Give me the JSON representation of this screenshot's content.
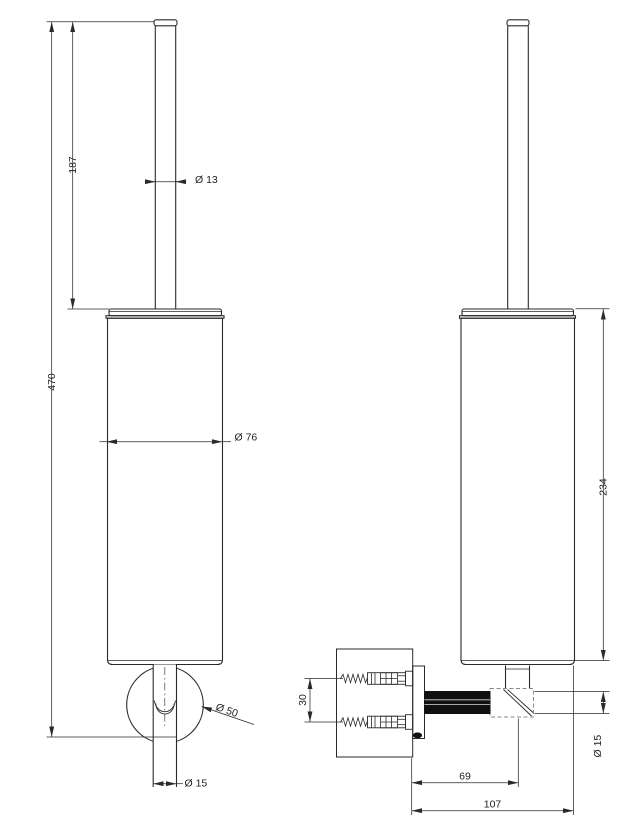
{
  "dimensions": {
    "front": {
      "total_height": "470",
      "rod_height": "187",
      "rod_diameter": "Ø 13",
      "body_diameter": "Ø 76",
      "flange_diameter": "Ø 50",
      "tube_diameter": "Ø 15"
    },
    "side": {
      "body_height": "234",
      "screw_spacing": "30",
      "wall_to_axis": "69",
      "wall_to_front": "107",
      "arm_diameter": "Ø 15"
    }
  },
  "colors": {
    "line": "#2a2a2a",
    "background": "#ffffff",
    "arm_fill": "#101010",
    "hidden_line": "#8a8a8a"
  }
}
